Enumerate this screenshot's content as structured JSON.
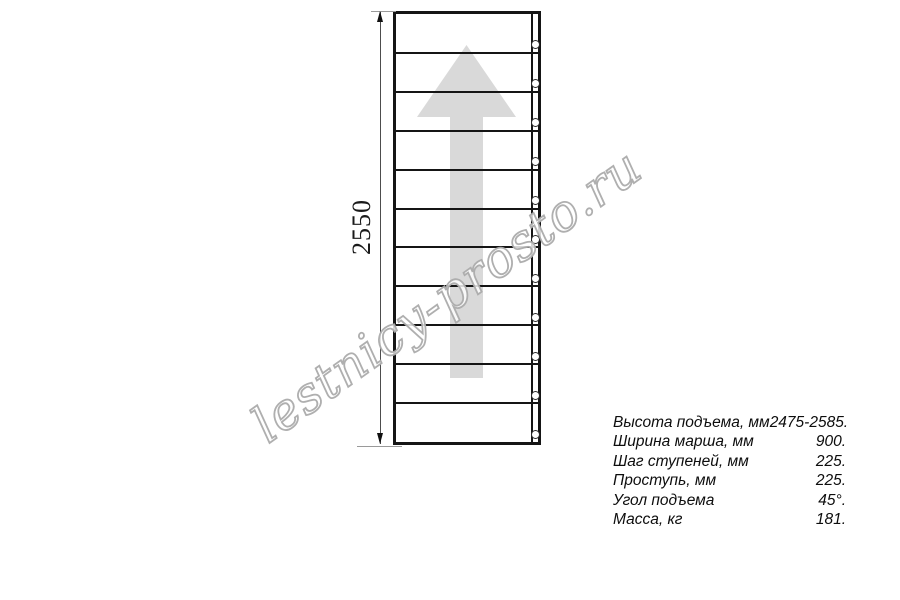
{
  "drawing": {
    "height_dimension_label": "2550",
    "tread_count": 11,
    "colors": {
      "line": "#151515",
      "arrow_fill": "#d9d9d9",
      "dimension_line": "#4d4d4d",
      "watermark_outline": "#ababab"
    }
  },
  "watermark": {
    "text": "lestnicy-prosto.ru"
  },
  "specs": {
    "rows": [
      {
        "label": "Высота подъема, мм",
        "value": "2475-2585."
      },
      {
        "label": "Ширина марша, мм",
        "value": "900."
      },
      {
        "label": "Шаг ступеней, мм",
        "value": "225."
      },
      {
        "label": "Проступь, мм",
        "value": "225."
      },
      {
        "label": "Угол подъема",
        "value": "45°."
      },
      {
        "label": "Масса, кг",
        "value": "181."
      }
    ]
  }
}
